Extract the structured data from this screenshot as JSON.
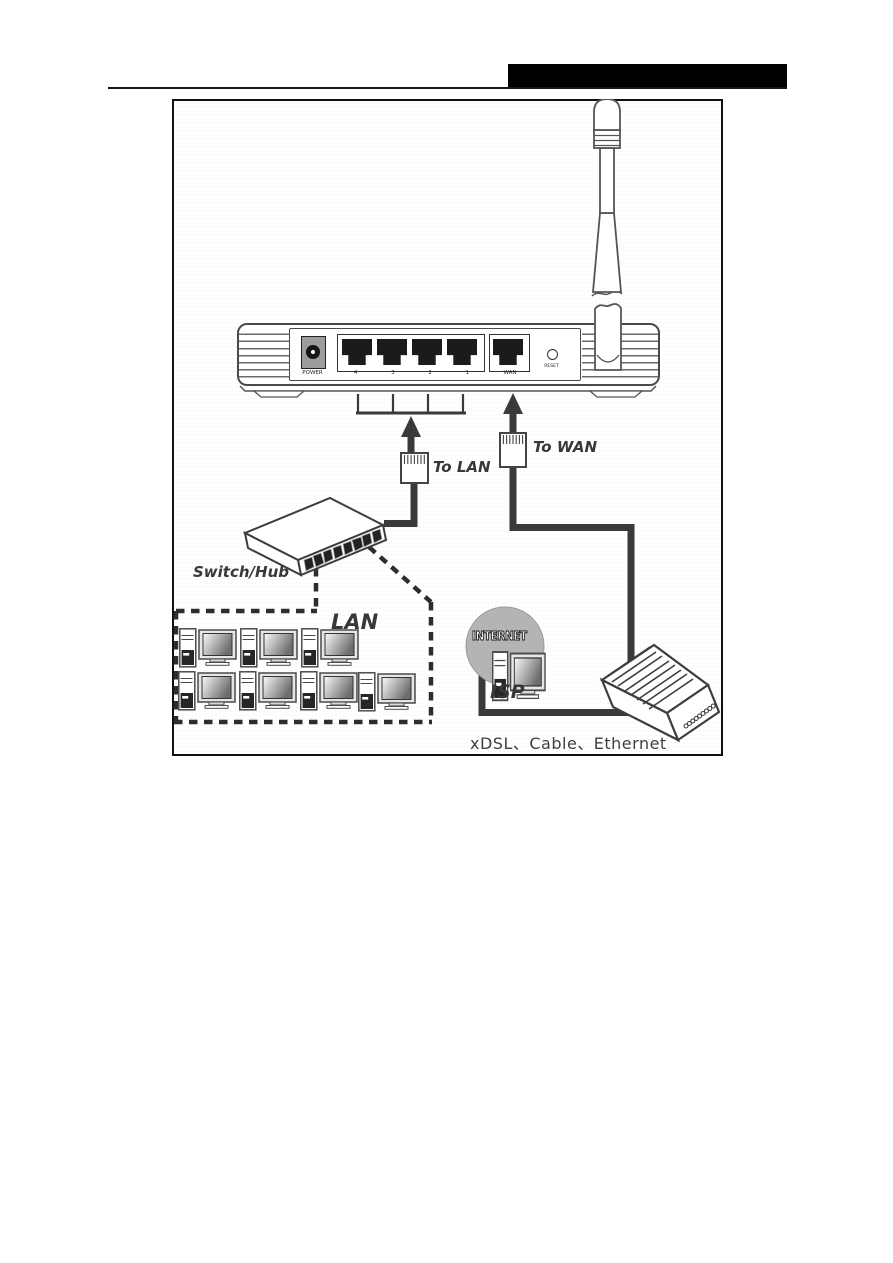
{
  "figure": {
    "router": {
      "power_label": "POWER",
      "lan_port_labels": [
        "4",
        "3",
        "2",
        "1"
      ],
      "wan_label": "WAN",
      "reset_label": "RESET"
    },
    "cables": {
      "to_lan": "To LAN",
      "to_wan": "To WAN"
    },
    "network": {
      "switch_hub": "Switch/Hub",
      "lan": "LAN",
      "internet": "INTERNET",
      "isp": "ISP",
      "wan_types": "xDSL、Cable、Ethernet"
    },
    "colors": {
      "line": "#3a3a3a",
      "cloud_fill": "#b4b4b4",
      "header_bar": "#000000"
    }
  }
}
